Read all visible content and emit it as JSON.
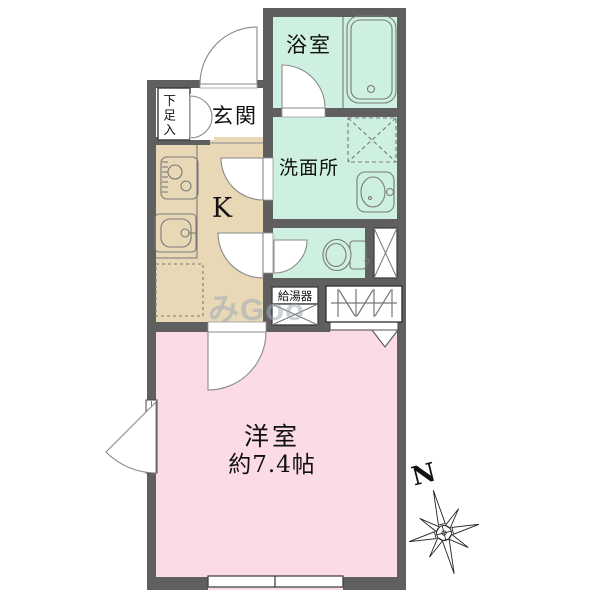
{
  "floorplan": {
    "rooms": {
      "bathroom": {
        "label": "浴室"
      },
      "washroom": {
        "label": "洗面所"
      },
      "entrance": {
        "label": "玄関"
      },
      "shoe_cabinet": {
        "label": "下足入"
      },
      "kitchen": {
        "label": "K"
      },
      "water_heater": {
        "label": "給湯器"
      },
      "western_room": {
        "label": "洋室",
        "area": "約7.4帖"
      }
    },
    "compass": {
      "north_label": "N"
    },
    "watermark": {
      "text": "みGoo"
    },
    "colors": {
      "wall": "#5f5f5f",
      "wet_area_fill": "#cdf0e0",
      "kitchen_fill": "#e8d8b6",
      "western_room_fill": "#fbdce4",
      "background": "#ffffff"
    }
  }
}
